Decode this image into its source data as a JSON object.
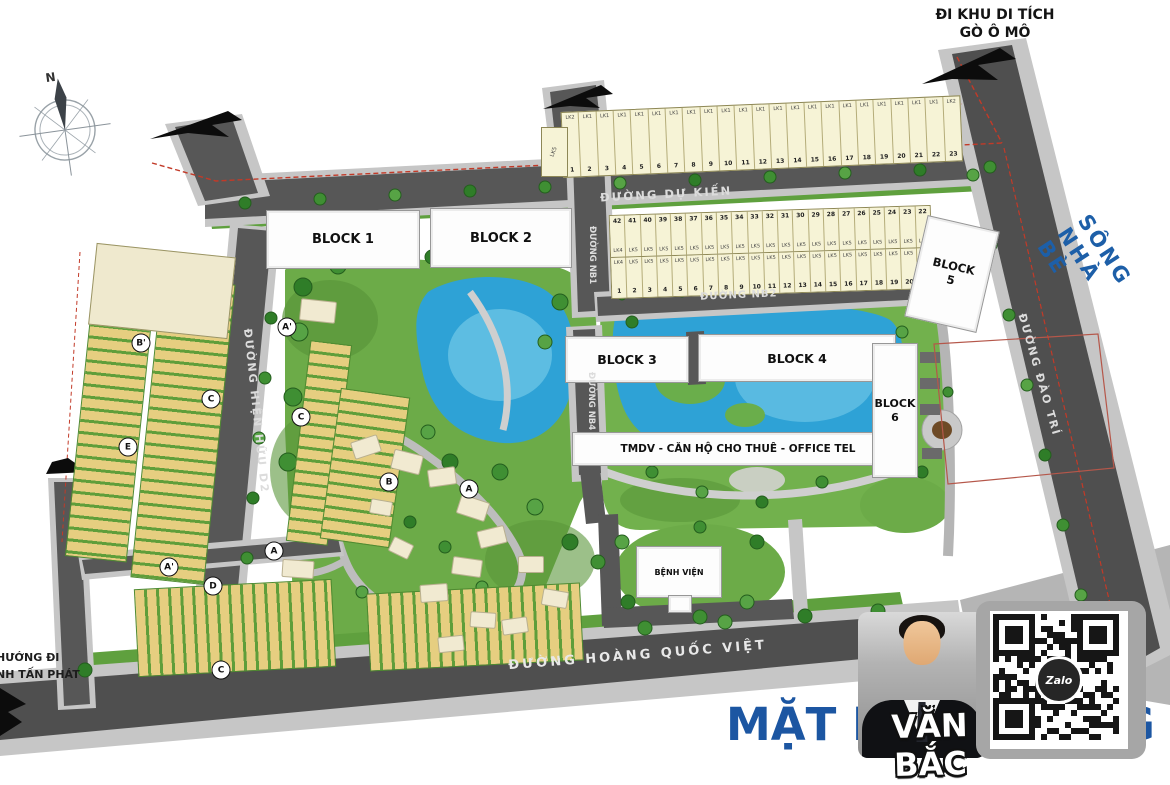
{
  "compass": {
    "north_label": "N"
  },
  "top_right": {
    "line1": "ĐI KHU DI TÍCH",
    "line2": "GÒ Ô MÔ"
  },
  "river": {
    "label": "SÔNG NHÀ BÈ"
  },
  "roads": {
    "du_kien": "ĐƯỜNG DỰ KIẾN",
    "nb1": "ĐƯỜNG NB1",
    "nb2": "ĐƯỜNG NB2",
    "nb4": "ĐƯỜNG NB4",
    "dao_tri": "ĐƯỜNG ĐÀO TRÍ",
    "hien_huu_d2": "ĐƯỜNG HIỆN HỮU D2",
    "hoang_quoc_viet": "ĐƯỜNG  HOÀNG QUỐC VIỆT",
    "huong_di_line1": "HƯỚNG ĐI",
    "huong_di_line2": "NH TẤN PHÁT"
  },
  "buildings": {
    "block1": "BLOCK 1",
    "block2": "BLOCK 2",
    "block3": "BLOCK 3",
    "block4": "BLOCK 4",
    "block5_line1": "BLOCK",
    "block5_line2": "5",
    "block6_line1": "BLOCK",
    "block6_line2": "6",
    "tmdv": "TMDV - CĂN HỘ CHO THUÊ - OFFICE TEL",
    "hospital": "BỆNH VIỆN",
    "lk5_lot": "LK5"
  },
  "lot_strip_1": {
    "labels": [
      "LK2",
      "LK1",
      "LK1",
      "LK1",
      "LK1",
      "LK1",
      "LK1",
      "LK1",
      "LK1",
      "LK1",
      "LK1",
      "LK1",
      "LK1",
      "LK1",
      "LK1",
      "LK1",
      "LK1",
      "LK1",
      "LK1",
      "LK1",
      "LK1",
      "LK1",
      "LK2"
    ],
    "numbers": [
      "1",
      "2",
      "3",
      "4",
      "5",
      "6",
      "7",
      "8",
      "9",
      "10",
      "11",
      "12",
      "13",
      "14",
      "15",
      "16",
      "17",
      "18",
      "19",
      "20",
      "21",
      "22",
      "23"
    ]
  },
  "lot_strip_2": {
    "row1_numbers": [
      "42",
      "41",
      "40",
      "39",
      "38",
      "37",
      "36",
      "35",
      "34",
      "33",
      "32",
      "31",
      "30",
      "29",
      "28",
      "27",
      "26",
      "25",
      "24",
      "23",
      "22"
    ],
    "row1_labels": [
      "LK4",
      "LK5",
      "LK5",
      "LK5",
      "LK5",
      "LK5",
      "LK5",
      "LK5",
      "LK5",
      "LK5",
      "LK5",
      "LK5",
      "LK5",
      "LK5",
      "LK5",
      "LK5",
      "LK5",
      "LK5",
      "LK5",
      "LK5",
      "LK5"
    ],
    "row2_labels": [
      "LK4",
      "LK5",
      "LK5",
      "LK5",
      "LK5",
      "LK5",
      "LK5",
      "LK5",
      "LK5",
      "LK5",
      "LK5",
      "LK5",
      "LK5",
      "LK5",
      "LK5",
      "LK5",
      "LK5",
      "LK5",
      "LK5",
      "LK5",
      "LK5"
    ],
    "row2_numbers": [
      "1",
      "2",
      "3",
      "4",
      "5",
      "6",
      "7",
      "8",
      "9",
      "10",
      "11",
      "12",
      "13",
      "14",
      "15",
      "16",
      "17",
      "18",
      "19",
      "20",
      "21"
    ]
  },
  "markers": [
    {
      "label": "B'",
      "x": 141,
      "y": 343
    },
    {
      "label": "C",
      "x": 211,
      "y": 399
    },
    {
      "label": "E",
      "x": 128,
      "y": 447
    },
    {
      "label": "A'",
      "x": 287,
      "y": 327
    },
    {
      "label": "C",
      "x": 301,
      "y": 417
    },
    {
      "label": "A'",
      "x": 169,
      "y": 567
    },
    {
      "label": "A",
      "x": 274,
      "y": 551
    },
    {
      "label": "D",
      "x": 213,
      "y": 586
    },
    {
      "label": "C",
      "x": 221,
      "y": 670
    },
    {
      "label": "B",
      "x": 389,
      "y": 482
    },
    {
      "label": "A",
      "x": 469,
      "y": 489
    }
  ],
  "footer": {
    "title": "MẶT BẰNG TỔNG",
    "agent_name": "VĂN BẮC",
    "zalo_label": "Zalo"
  }
}
